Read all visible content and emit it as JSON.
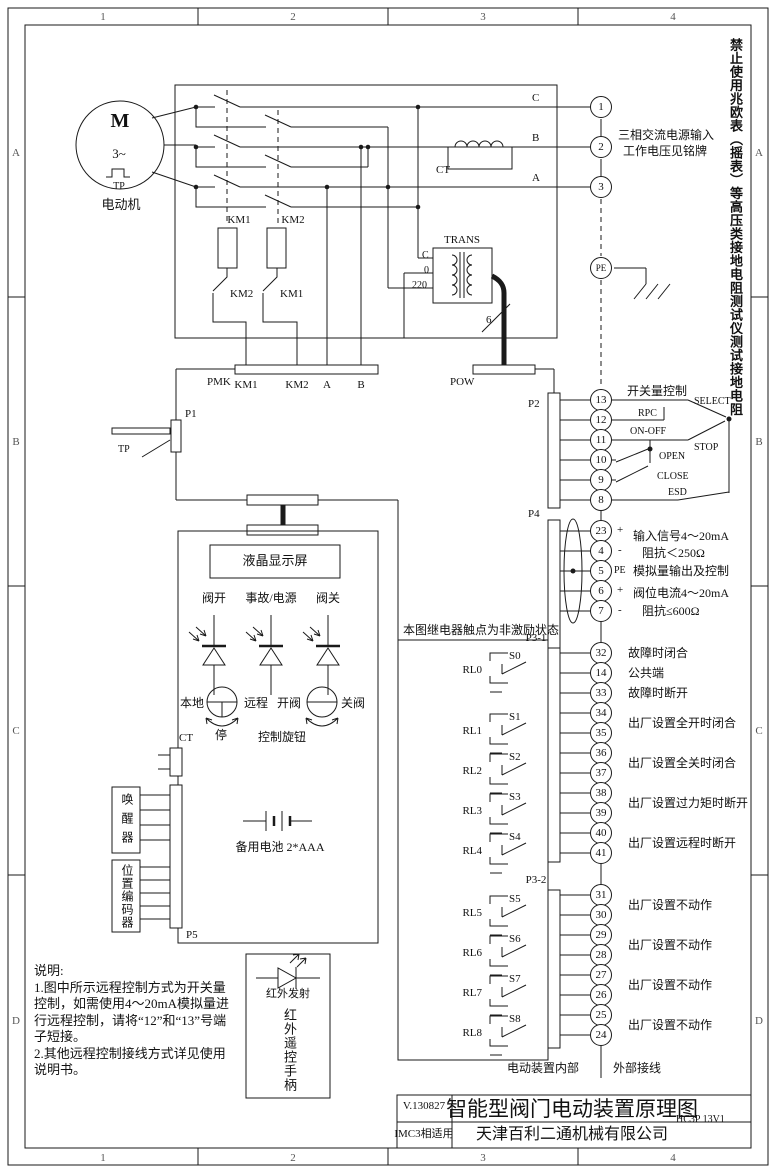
{
  "frame": {
    "zone_cols": [
      "1",
      "2",
      "3",
      "4"
    ],
    "zone_rows": [
      "A",
      "B",
      "C",
      "D"
    ],
    "warning": "禁止使用兆欧表（摇表）等高压类接地电阻测试仪测试接地电阻"
  },
  "motor": {
    "m": "M",
    "phase": "3~",
    "tp": "TP",
    "label": "电动机"
  },
  "power": {
    "km1": "KM1",
    "km2": "KM2",
    "km1_interlock": "KM2",
    "km2_interlock": "KM1",
    "ct": "CT",
    "trans": "TRANS",
    "tap_c": "C",
    "tap_0": "0",
    "tap_220": "220",
    "cable": "6",
    "phase_c": "C",
    "phase_b": "B",
    "phase_a": "A"
  },
  "connectors": {
    "pmk": "PMK",
    "pin_km1": "KM1",
    "pin_km2": "KM2",
    "pin_a": "A",
    "pin_b": "B",
    "pow": "POW",
    "p1": "P1",
    "tp": "TP",
    "p2": "P2",
    "p4": "P4",
    "p31": "P3-1",
    "p32": "P3-2",
    "p5": "P5",
    "ct": "CT"
  },
  "supply": {
    "terminals": [
      "1",
      "2",
      "3",
      "PE"
    ],
    "note1": "三相交流电源输入",
    "note2": "工作电压见铭牌"
  },
  "digital": {
    "title": "开关量控制",
    "terminals": [
      "13",
      "12",
      "11",
      "10",
      "9",
      "8"
    ],
    "select": "SELECT",
    "rpc": "RPC",
    "onoff": "ON-OFF",
    "stop": "STOP",
    "open": "OPEN",
    "close": "CLOSE",
    "esd": "ESD"
  },
  "analog": {
    "terminals": [
      "23",
      "4",
      "5",
      "6",
      "7"
    ],
    "signs": [
      "+",
      "-",
      "PE",
      "+",
      "-"
    ],
    "l1": "输入信号4～20mA",
    "l2": "阻抗＜250Ω",
    "l3": "模拟量输出及控制",
    "l4": "阀位电流4～20mA",
    "l5": "阻抗≤600Ω"
  },
  "relay_note": "本图继电器触点为非激励状态",
  "p31": {
    "terminals": [
      "32",
      "14",
      "33",
      "34",
      "35",
      "36",
      "37",
      "38",
      "39",
      "40",
      "41"
    ],
    "labels": [
      "故障时闭合",
      "公共端",
      "故障时断开",
      "出厂设置全开时闭合",
      "出厂设置全关时闭合",
      "出厂设置过力矩时断开",
      "出厂设置远程时断开"
    ]
  },
  "p32": {
    "terminals": [
      "31",
      "30",
      "29",
      "28",
      "27",
      "26",
      "25",
      "24"
    ],
    "labels": [
      "出厂设置不动作",
      "出厂设置不动作",
      "出厂设置不动作",
      "出厂设置不动作"
    ]
  },
  "relays": {
    "names": [
      "RL0",
      "RL1",
      "RL2",
      "RL3",
      "RL4",
      "RL5",
      "RL6",
      "RL7",
      "RL8"
    ],
    "switches": [
      "S0",
      "S1",
      "S2",
      "S3",
      "S4",
      "S5",
      "S6",
      "S7",
      "S8"
    ]
  },
  "panel": {
    "lcd": "液晶显示屏",
    "led_open": "阀开",
    "led_fault": "事故/电源",
    "led_close": "阀关",
    "local": "本地",
    "remote": "远程",
    "stop": "停",
    "open_valve": "开阀",
    "close_valve": "关阀",
    "knob": "控制旋钮",
    "battery": "备用电池  2*AAA",
    "wakeup": "唤醒器",
    "encoder": "位置编码器"
  },
  "ir": {
    "emit": "红外发射",
    "handle": "红外遥控手柄"
  },
  "footer": {
    "internal": "电动装置内部",
    "external": "外部接线"
  },
  "notes": {
    "title": "说明:",
    "lines": [
      "1.图中所示远程控制方式为开关量",
      "控制，如需使用4～20mA模拟量进",
      "行远程控制，请将“12”和“13”号端",
      "子短接。",
      "2.其他远程控制接线方式详见使用",
      "说明书。"
    ]
  },
  "titleblock": {
    "version": "V.130827",
    "title": "智能型阀门电动装置原理图",
    "code": "HC3P  13V1",
    "model": "IMC3相适用",
    "company": "天津百利二通机械有限公司"
  }
}
